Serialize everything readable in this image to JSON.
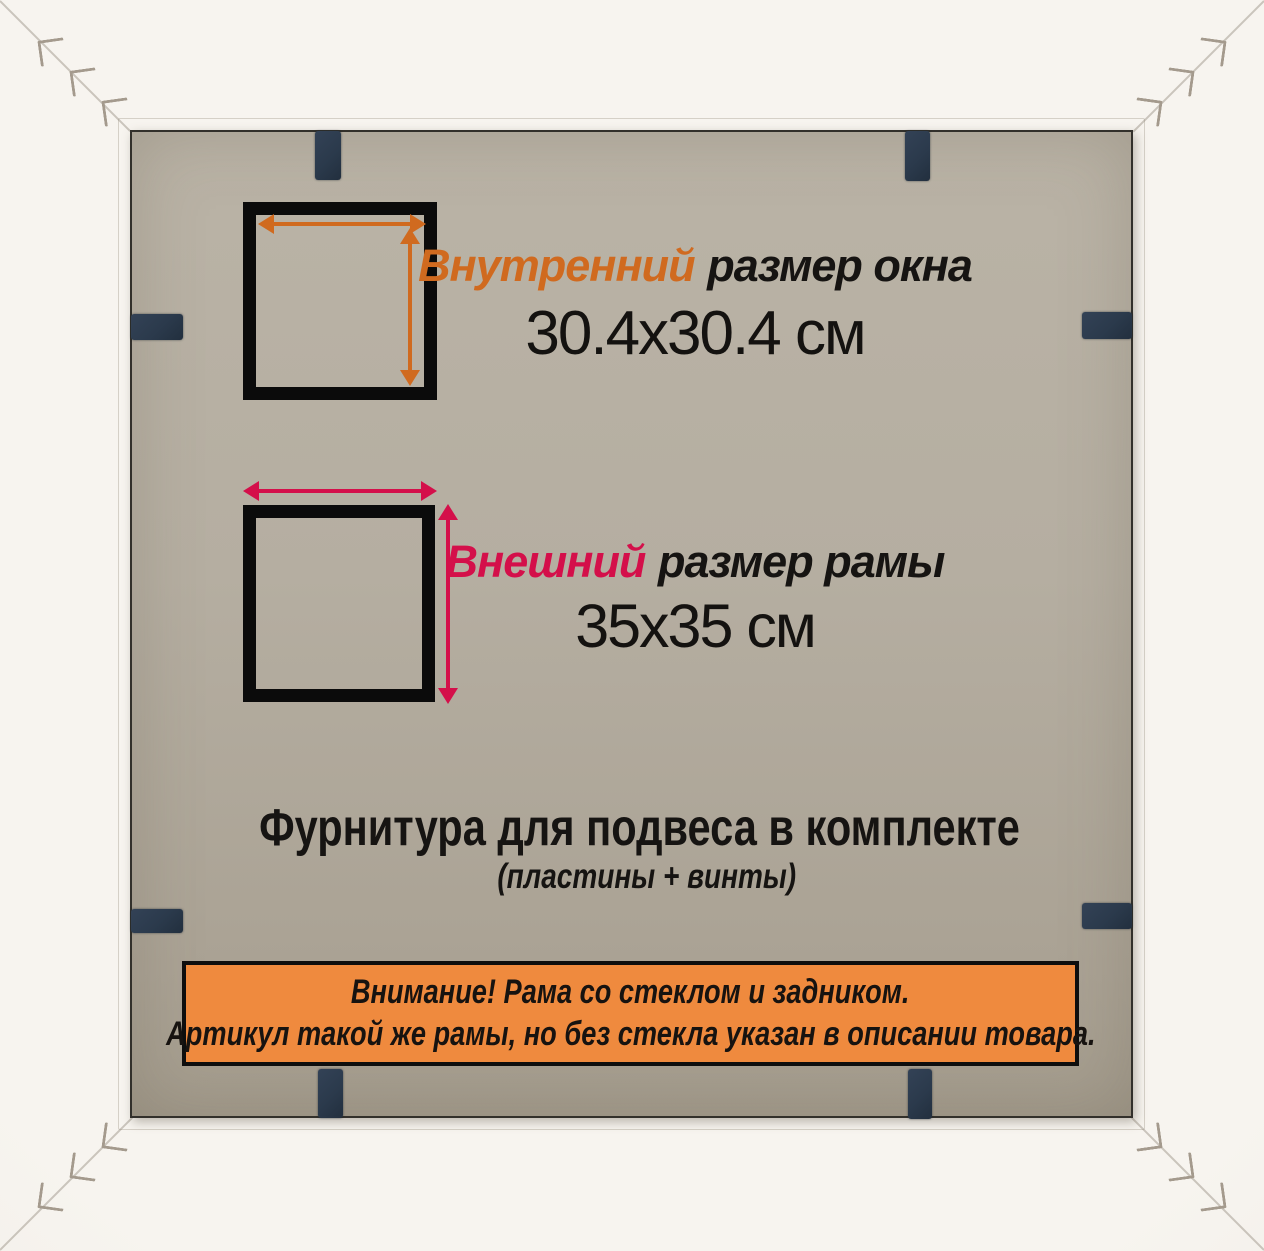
{
  "product_card": {
    "inner_size": {
      "label_highlight": "Внутренний",
      "label_rest": "размер окна",
      "value": "30.4x30.4 см"
    },
    "outer_size": {
      "label_highlight": "Внешний",
      "label_rest": "размер рамы",
      "value": "35x35 см"
    },
    "hardware": {
      "line1": "Фурнитура для подвеса в комплекте",
      "line2": "(пластины + винты)"
    },
    "attention_banner": {
      "line1": "Внимание! Рама со стеклом и задником.",
      "line2": "Артикул такой же рамы, но без стекла указан в описании товара."
    },
    "colors": {
      "inner_accent_orange": "#d06a1f",
      "outer_accent_crimson": "#d40f4a",
      "banner_orange": "#ef8a3e",
      "clip_navy": "#2b3a4c",
      "backing_gray": "#b5aea1",
      "frame_white": "#f4f1ea",
      "diagram_black": "#0b0b0b"
    },
    "icons": {
      "frame_clip": "navy rectangle tab",
      "v_nail_staple": "L-shaped corner staple mark",
      "measure_arrow": "double-headed arrow"
    }
  }
}
